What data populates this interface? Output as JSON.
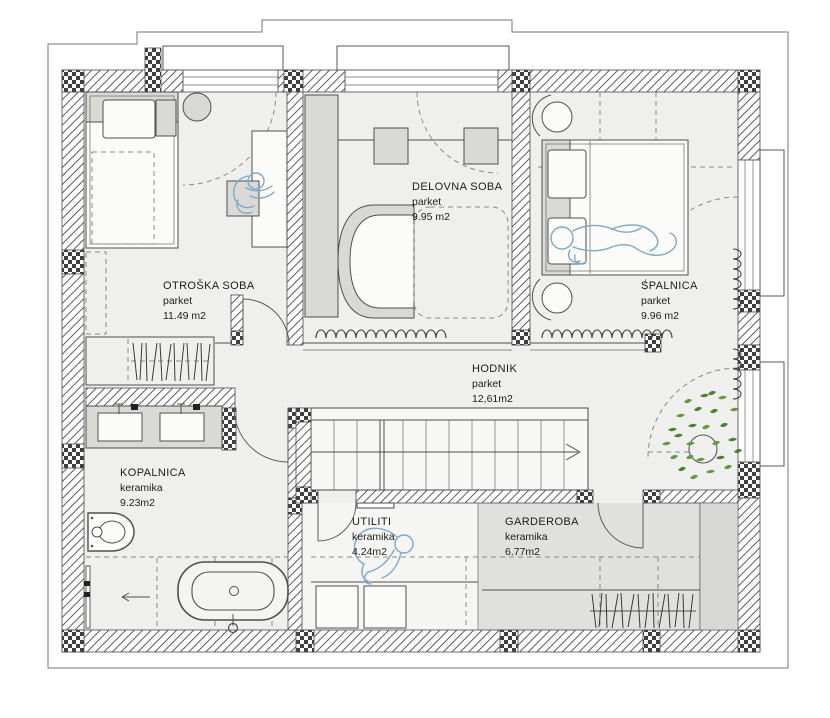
{
  "title": "Nadstropje - tloris",
  "rooms": [
    {
      "name": "OTROŠKA SOBA",
      "floor": "parket",
      "area": "11.49 m2"
    },
    {
      "name": "DELOVNA SOBA",
      "floor": "parket",
      "area": "9.95 m2"
    },
    {
      "name": "SPALNICA",
      "floor": "parket",
      "area": "9.96 m2"
    },
    {
      "name": "HODNIK",
      "floor": "parket",
      "area": "12,61m2"
    },
    {
      "name": "KOPALNICA",
      "floor": "keramika",
      "area": "9.23m2"
    },
    {
      "name": "UTILITI",
      "floor": "keramika",
      "area": "4.24m2"
    },
    {
      "name": "GARDEROBA",
      "floor": "keramika",
      "area": "6.77m2"
    }
  ],
  "colors": {
    "wall_line": "#4a4a4a",
    "floor": "#efefee",
    "floor_garderoba": "#e0e0de",
    "furniture": "#d9d9d6",
    "sketch_blue": "#7fa8c9",
    "plant_green": "#67983b",
    "text": "#1c1c1c"
  }
}
